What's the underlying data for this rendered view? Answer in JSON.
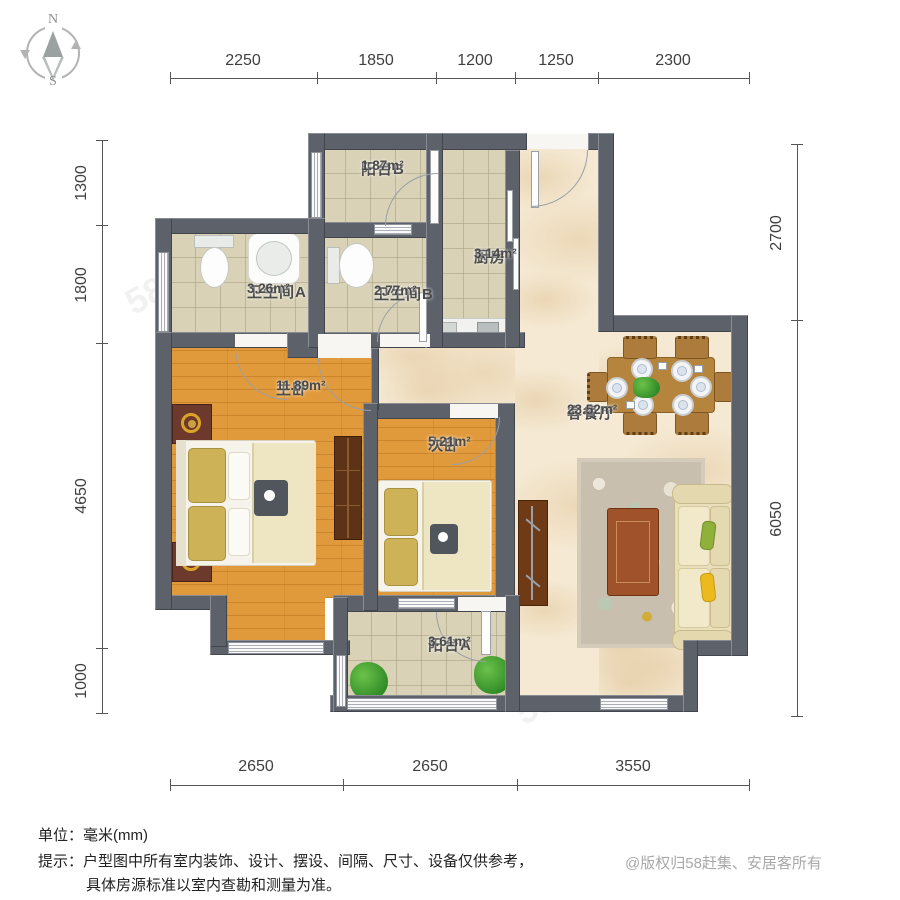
{
  "compass": {
    "north": "N",
    "south": "S"
  },
  "dimensions": {
    "top": [
      "2250",
      "1850",
      "1200",
      "1250",
      "2300"
    ],
    "left": [
      "1300",
      "1800",
      "4650",
      "1000"
    ],
    "right": [
      "2700",
      "6050"
    ],
    "bottom": [
      "2650",
      "2650",
      "3550"
    ]
  },
  "rooms": {
    "balcony_b": {
      "name": "阳台B",
      "area": "1.87m²"
    },
    "kitchen": {
      "name": "厨房",
      "area": "3.14m²"
    },
    "bath_a": {
      "name": "卫生间A",
      "area": "3.26m²"
    },
    "bath_b": {
      "name": "卫生间B",
      "area": "2.77m²"
    },
    "master_bedroom": {
      "name": "主卧",
      "area": "11.89m²"
    },
    "second_bedroom": {
      "name": "次卧",
      "area": "5.21m²"
    },
    "living_dining": {
      "name": "客餐厅",
      "area": "23.52m²"
    },
    "balcony_a": {
      "name": "阳台A",
      "area": "3.61m²"
    }
  },
  "footer": {
    "unit_note": "单位：毫米(mm)",
    "tip_line1": "提示：户型图中所有室内装饰、设计、摆设、间隔、尺寸、设备仅供参考，",
    "tip_line2": "具体房源标准以室内查勘和测量为准。",
    "copyright": "@版权归58赶集、安居客所有"
  },
  "watermark": {
    "text": "58同城"
  },
  "colors": {
    "wall": "#5c616a",
    "wood_floor": "#e19a3b",
    "tile_floor": "#d9d2b7",
    "marble_floor": "#f5e9d3",
    "accent_wood": "#b5853e",
    "sofa": "#e9dfba"
  }
}
